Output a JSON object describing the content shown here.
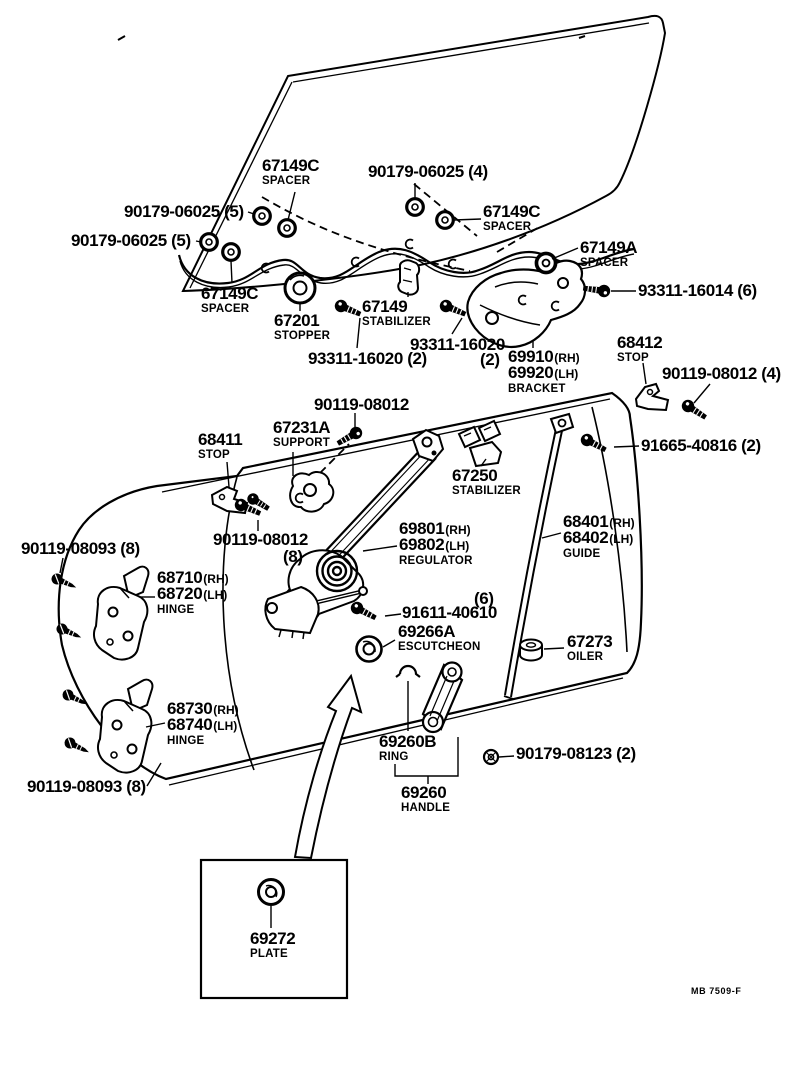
{
  "theme": {
    "ink": "#000000",
    "paper": "#ffffff"
  },
  "figure": {
    "description": "Front door window exploded parts diagram"
  },
  "labels": {
    "spacer_c1": {
      "num": "67149C",
      "sub": "SPACER"
    },
    "qty06025_4": {
      "num": "90179-06025 (4)"
    },
    "qty06025_5a": {
      "num": "90179-06025 (5)"
    },
    "qty06025_5b": {
      "num": "90179-06025 (5)"
    },
    "spacer_c2": {
      "num": "67149C",
      "sub": "SPACER"
    },
    "spacer_a": {
      "num": "67149A",
      "sub": "SPACER"
    },
    "bolt16014": {
      "num": "93311-16014 (6)"
    },
    "spacer_c3": {
      "num": "67149C",
      "sub": "SPACER"
    },
    "stopper": {
      "num": "67201",
      "sub": "STOPPER"
    },
    "stab67149": {
      "num": "67149",
      "sub": "STABILIZER"
    },
    "bolt16020_r": {
      "num": "93311-16020"
    },
    "bolt16020_r_qty": {
      "num": "(2)"
    },
    "bolt16020_l": {
      "num": "93311-16020 (2)"
    },
    "bracket": {
      "num1": "69910",
      "tag1": "(RH)",
      "num2": "69920",
      "tag2": "(LH)",
      "sub": "BRACKET"
    },
    "stop68412": {
      "num": "68412",
      "sub": "STOP"
    },
    "bolt08012_4": {
      "num": "90119-08012 (4)"
    },
    "bolt08012_c": {
      "num": "90119-08012"
    },
    "stop68411": {
      "num": "68411",
      "sub": "STOP"
    },
    "support": {
      "num": "67231A",
      "sub": "SUPPORT"
    },
    "stab67250": {
      "num": "67250",
      "sub": "STABILIZER"
    },
    "bolt40816": {
      "num": "91665-40816 (2)"
    },
    "regulator": {
      "num1": "69801",
      "tag1": "(RH)",
      "num2": "69802",
      "tag2": "(LH)",
      "sub": "REGULATOR"
    },
    "guide": {
      "num1": "68401",
      "tag1": "(RH)",
      "num2": "68402",
      "tag2": "(LH)",
      "sub": "GUIDE"
    },
    "bolt08093_t": {
      "num": "90119-08093 (8)"
    },
    "bolt08012_8": {
      "num": "90119-08012"
    },
    "bolt08012_8_qty": {
      "num": "(8)"
    },
    "hinge_u": {
      "num1": "68710",
      "tag1": "(RH)",
      "num2": "68720",
      "tag2": "(LH)",
      "sub": "HINGE"
    },
    "qty6": {
      "num": "(6)"
    },
    "bolt40610": {
      "num": "91611-40610"
    },
    "escutcheon": {
      "num": "69266A",
      "sub": "ESCUTCHEON"
    },
    "oiler": {
      "num": "67273",
      "sub": "OILER"
    },
    "hinge_l": {
      "num1": "68730",
      "tag1": "(RH)",
      "num2": "68740",
      "tag2": "(LH)",
      "sub": "HINGE"
    },
    "bolt08093_b": {
      "num": "90119-08093 (8)"
    },
    "ring": {
      "num": "69260B",
      "sub": "RING"
    },
    "bolt08123": {
      "num": "90179-08123 (2)"
    },
    "handle": {
      "num": "69260",
      "sub": "HANDLE"
    },
    "plate": {
      "num": "69272",
      "sub": "PLATE"
    }
  },
  "footer": {
    "code": "MB 7509-F"
  }
}
